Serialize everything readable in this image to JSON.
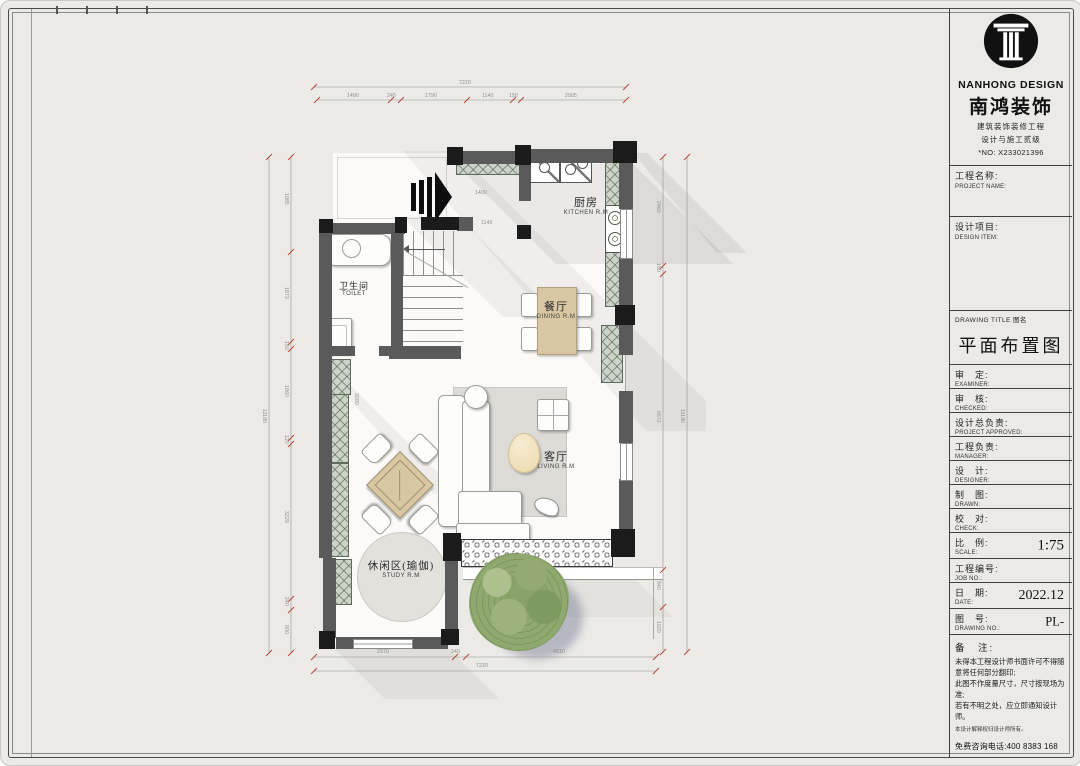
{
  "colors": {
    "wall": "#5a5a5a",
    "column": "#1b1b1b",
    "cabinet_hatch": "#ccd3c9",
    "wood": "#d9c6a2",
    "dim_tick": "#b5413a",
    "paper": "#ebeae7"
  },
  "sheet": {
    "brand": {
      "name_en": "NANHONG DESIGN",
      "name_cn": "南鸿装饰",
      "cert_line1": "建筑装饰装修工程",
      "cert_line2": "设计与施工贰级",
      "license_no": "*NO: X233021396"
    },
    "project": {
      "cn": "工程名称:",
      "en": "PROJECT NAME:",
      "value": ""
    },
    "design_item": {
      "cn": "设计项目:",
      "en": "DESIGN ITEM:",
      "value": ""
    },
    "drawing_title": {
      "label": "DRAWING TITLE 图名",
      "value": "平面布置图"
    },
    "rows": [
      {
        "cn": "审　定:",
        "en": "EXAMINER:",
        "value": ""
      },
      {
        "cn": "审　核:",
        "en": "CHECKED:",
        "value": ""
      },
      {
        "cn": "设计总负责:",
        "en": "PROJECT APPROVED:",
        "value": ""
      },
      {
        "cn": "工程负责:",
        "en": "MANAGER:",
        "value": ""
      },
      {
        "cn": "设　计:",
        "en": "DESIGNER:",
        "value": ""
      },
      {
        "cn": "制　图:",
        "en": "DRAWN:",
        "value": ""
      },
      {
        "cn": "校　对:",
        "en": "CHECK:",
        "value": ""
      },
      {
        "cn": "比　例:",
        "en": "SCALE:",
        "value": "1:75"
      },
      {
        "cn": "工程编号:",
        "en": "JOB NO.:",
        "value": ""
      },
      {
        "cn": "日　期:",
        "en": "DATE:",
        "value": "2022.12"
      },
      {
        "cn": "图　号:",
        "en": "DRAWING NO.:",
        "value": "PL-"
      }
    ],
    "notes": {
      "label": "备　注:",
      "line1": "未得本工程设计师书面许可不得随意将任何部分翻印;",
      "line2": "此图不作度量尺寸，尺寸按现场为准;",
      "line3": "若有不明之处，应立即通知设计师。",
      "line4": "本设计解释权归设计师所有。",
      "hotline": "免费咨询电话:400 8383 168"
    }
  },
  "plan": {
    "rooms": {
      "kitchen": {
        "cn": "厨房",
        "en": "KITCHEN R.M"
      },
      "toilet": {
        "cn": "卫生间",
        "en": "TOILET"
      },
      "dining": {
        "cn": "餐厅",
        "en": "DINING R.M"
      },
      "living": {
        "cn": "客厅",
        "en": "LIVING R.M"
      },
      "study": {
        "cn": "休闲区(瑜伽)",
        "en": "STUDY R.M"
      }
    },
    "dims": {
      "top_total": "7220",
      "top": [
        "1490",
        "245",
        "1790",
        "1140",
        "150",
        "2905"
      ],
      "bottom": [
        "2970",
        "240",
        "4010"
      ],
      "bottom_total": "7220",
      "left": [
        "1985",
        "1873",
        "150",
        "1860",
        "120",
        "3229",
        "240",
        "900"
      ],
      "left_total": "11180",
      "right": [
        "2460",
        "180",
        "6672",
        "840",
        "1020"
      ],
      "right_total": "11180",
      "inner_a": "1400",
      "inner_b": "1140",
      "inner_c": "3000"
    }
  }
}
